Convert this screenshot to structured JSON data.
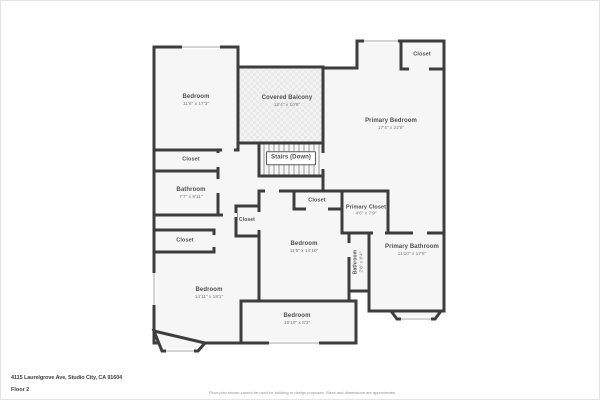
{
  "page": {
    "type": "floor-plan-sheet"
  },
  "rooms": {
    "bedroom_top_left": {
      "name": "Bedroom",
      "dims": "11'6\" x 17'3\""
    },
    "covered_balcony": {
      "name": "Covered Balcony",
      "dims": "12'4\" x 10'9\""
    },
    "stairs": {
      "name": "Stairs (Down)"
    },
    "primary_bedroom": {
      "name": "Primary Bedroom",
      "dims": "17'4\" x 22'8\""
    },
    "closet_primary_corner": {
      "name": "Closet"
    },
    "closet_upper_left": {
      "name": "Closet"
    },
    "bathroom_left": {
      "name": "Bathroom",
      "dims": "7'7\" x 8'11\""
    },
    "closet_lower_left": {
      "name": "Closet"
    },
    "bedroom_lower_left": {
      "name": "Bedroom",
      "dims": "14'11\" x 18'1\""
    },
    "closet_hall_small": {
      "name": "Closet"
    },
    "closet_center": {
      "name": "Closet"
    },
    "bedroom_center": {
      "name": "Bedroom",
      "dims": "11'5\" x 14'10\""
    },
    "primary_closet": {
      "name": "Primary Closet",
      "dims": "4'6\" x 7'9\""
    },
    "bathroom_small": {
      "name": "Bathroom",
      "dims": "2'8\" x 8'4\""
    },
    "primary_bathroom": {
      "name": "Primary Bathroom",
      "dims": "11'10\" x 17'6\""
    },
    "bedroom_bottom": {
      "name": "Bedroom",
      "dims": "16'10\" x 6'3\""
    }
  },
  "footer": {
    "address": "4115 Laurelgrove Ave, Studio City, CA 91604",
    "floor": "Floor 2",
    "disclaimer": "Floor plan shown cannot be used for building or design purposes. Sizes and dimensions are approximate."
  },
  "colors": {
    "wall": "#3d3d3d",
    "room_fill": "#f6f6f6",
    "balcony_fill": "#e9e9e9",
    "label_text": "#4f4f4f",
    "dims_text": "#7a7a7a",
    "page_bg": "#ffffff",
    "frame_border": "#e3e3e3"
  }
}
